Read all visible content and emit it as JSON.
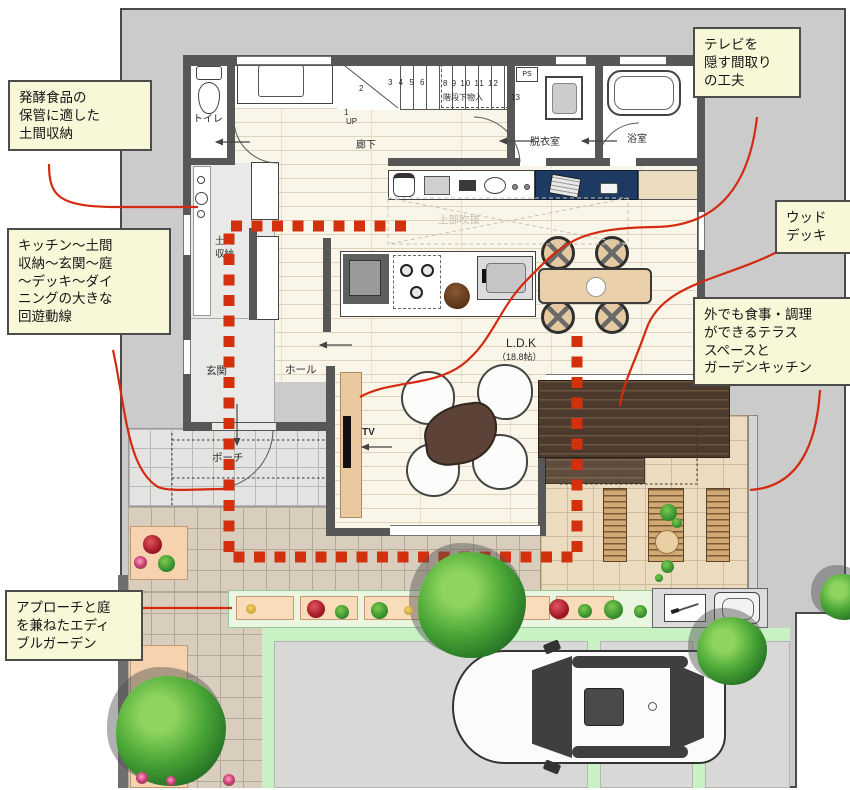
{
  "title": "戸建て1階 間取り図（回遊動線プラン）",
  "colors": {
    "accent_red": "#d42a10",
    "dotted_red": "#d3310e",
    "callout_bg": "#f8f8d9",
    "callout_border": "#4c4c4c",
    "wall": "#575757",
    "site": "#cbcbcb",
    "deck_brown": "#4c3b2d",
    "navy_counter": "#1d3a63",
    "grass_green": "#c8f2c4"
  },
  "callouts": {
    "storage": {
      "lines": [
        "発酵食品の",
        "保管に適した",
        "土間収納"
      ]
    },
    "circulation": {
      "lines": [
        "キッチン〜土間",
        "収納〜玄関〜庭",
        "〜デッキ〜ダイ",
        "ニングの大きな",
        "回遊動線"
      ]
    },
    "garden": {
      "lines": [
        "アプローチと庭",
        "を兼ねたエディ",
        "ブルガーデン"
      ]
    },
    "tv": {
      "lines": [
        "テレビを",
        "隠す間取り",
        "の工夫"
      ]
    },
    "deck": {
      "lines": [
        "ウッド",
        "デッキ"
      ]
    },
    "terrace": {
      "lines": [
        "外でも食事・調理",
        "ができるテラス",
        "スペースと",
        "ガーデンキッチン"
      ]
    }
  },
  "rooms": {
    "toilet": "トイレ",
    "corridor": "廊下",
    "understairs": "階段下物入",
    "ps": "PS",
    "dressing": "脱衣室",
    "bath": "浴室",
    "doma_line1": "土間",
    "doma_line2": "収納",
    "entrance": "玄関",
    "hall": "ホール",
    "porch": "ポーチ",
    "ldk": "L.D.K",
    "ldk_size": "（18.8帖）",
    "void": "上部吹抜",
    "tv": "TV"
  },
  "stairs": {
    "up": "UP",
    "n1": "1",
    "n2": "2",
    "row1": "3 4 5 6",
    "row2": "8 9 10 11 12",
    "n13": "13"
  }
}
